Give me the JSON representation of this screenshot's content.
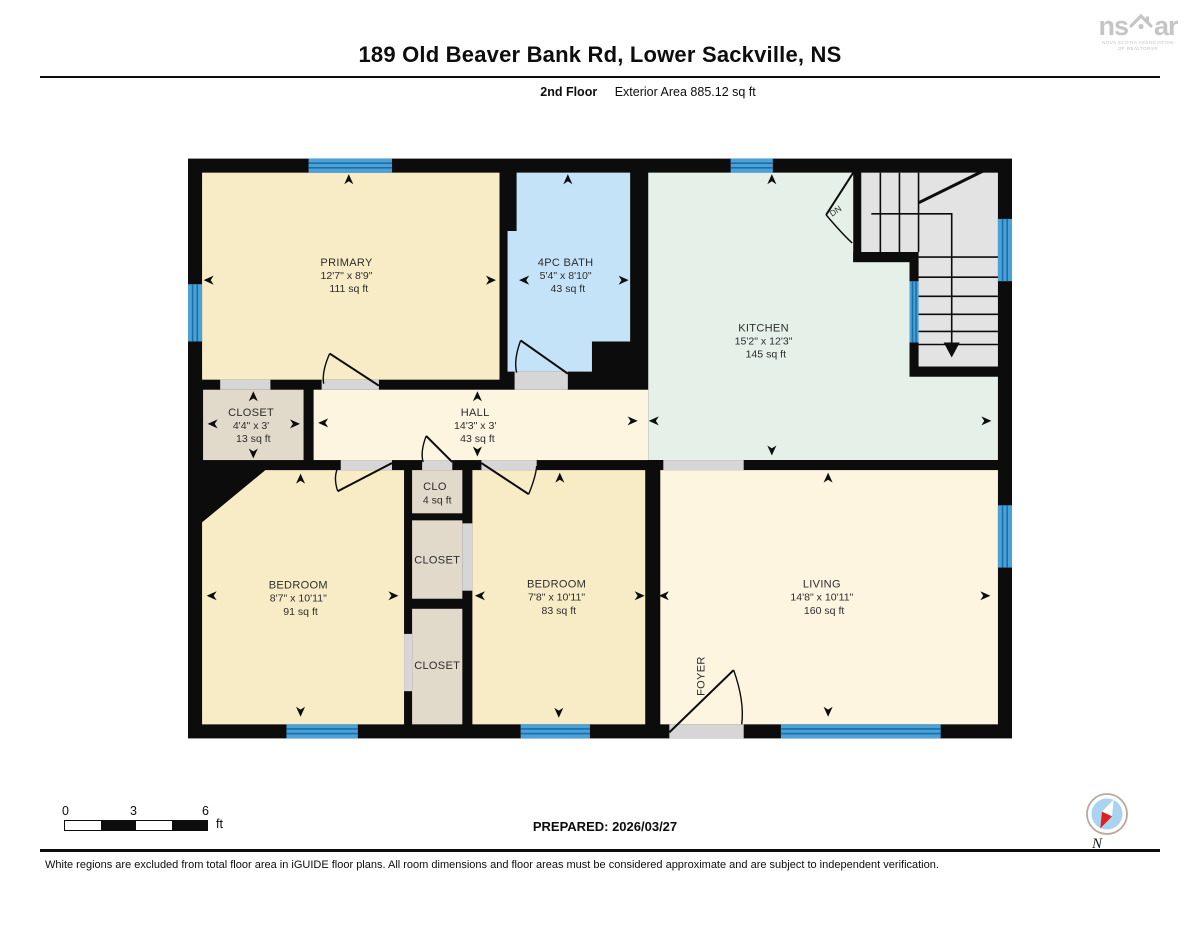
{
  "header": {
    "title": "189 Old Beaver Bank Rd, Lower Sackville, NS",
    "floor": "2nd Floor",
    "area": "Exterior Area 885.12 sq ft"
  },
  "logo": {
    "word_left": "ns",
    "word_right": "ar",
    "tagline_line1": "NOVA SCOTIA ASSOCIATION",
    "tagline_line2": "OF REALTORS®"
  },
  "plan": {
    "rooms": [
      {
        "name": "PRIMARY",
        "dims": "12'7\" x 8'9\"",
        "area": "111 sq ft"
      },
      {
        "name": "4PC BATH",
        "dims": "5'4\" x 8'10\"",
        "area": "43 sq ft"
      },
      {
        "name": "KITCHEN",
        "dims": "15'2\" x 12'3\"",
        "area": "145 sq ft"
      },
      {
        "name": "CLOSET",
        "dims": "4'4\" x 3'",
        "area": "13 sq ft"
      },
      {
        "name": "HALL",
        "dims": "14'3\" x 3'",
        "area": "43 sq ft"
      },
      {
        "name": "CLO",
        "area": "4 sq ft"
      },
      {
        "name": "CLOSET"
      },
      {
        "name": "CLOSET"
      },
      {
        "name": "BEDROOM",
        "dims": "8'7\" x 10'11\"",
        "area": "91 sq ft"
      },
      {
        "name": "BEDROOM",
        "dims": "7'8\" x 10'11\"",
        "area": "83 sq ft"
      },
      {
        "name": "LIVING",
        "dims": "14'8\" x 10'11\"",
        "area": "160 sq ft"
      },
      {
        "name": "FOYER"
      }
    ],
    "stair_label": "DN",
    "colors": {
      "wall": "#0c0c0c",
      "room_cream": "#f8ecc6",
      "room_cream_light": "#fdf5e0",
      "bath_blue": "#c4e3f8",
      "kitchen_green": "#e4f0e8",
      "closet_tan": "#e1d9ca",
      "stairs_gray": "#e3e3e3",
      "threshold_gray": "#d6d6d6",
      "window_blue": "#4aa2d9",
      "window_line": "#1d6ea6",
      "compass_needle_red": "#e02020",
      "compass_disc_blue": "#a9d3f0"
    }
  },
  "footer": {
    "scale": {
      "tick0": "0",
      "tick1": "3",
      "tick2": "6",
      "unit": "ft"
    },
    "prepared": "PREPARED: 2026/03/27",
    "compass_label": "N",
    "disclaimer": "White regions are excluded from total floor area in iGUIDE floor plans. All room dimensions and floor areas must be considered approximate and are subject to independent verification."
  }
}
